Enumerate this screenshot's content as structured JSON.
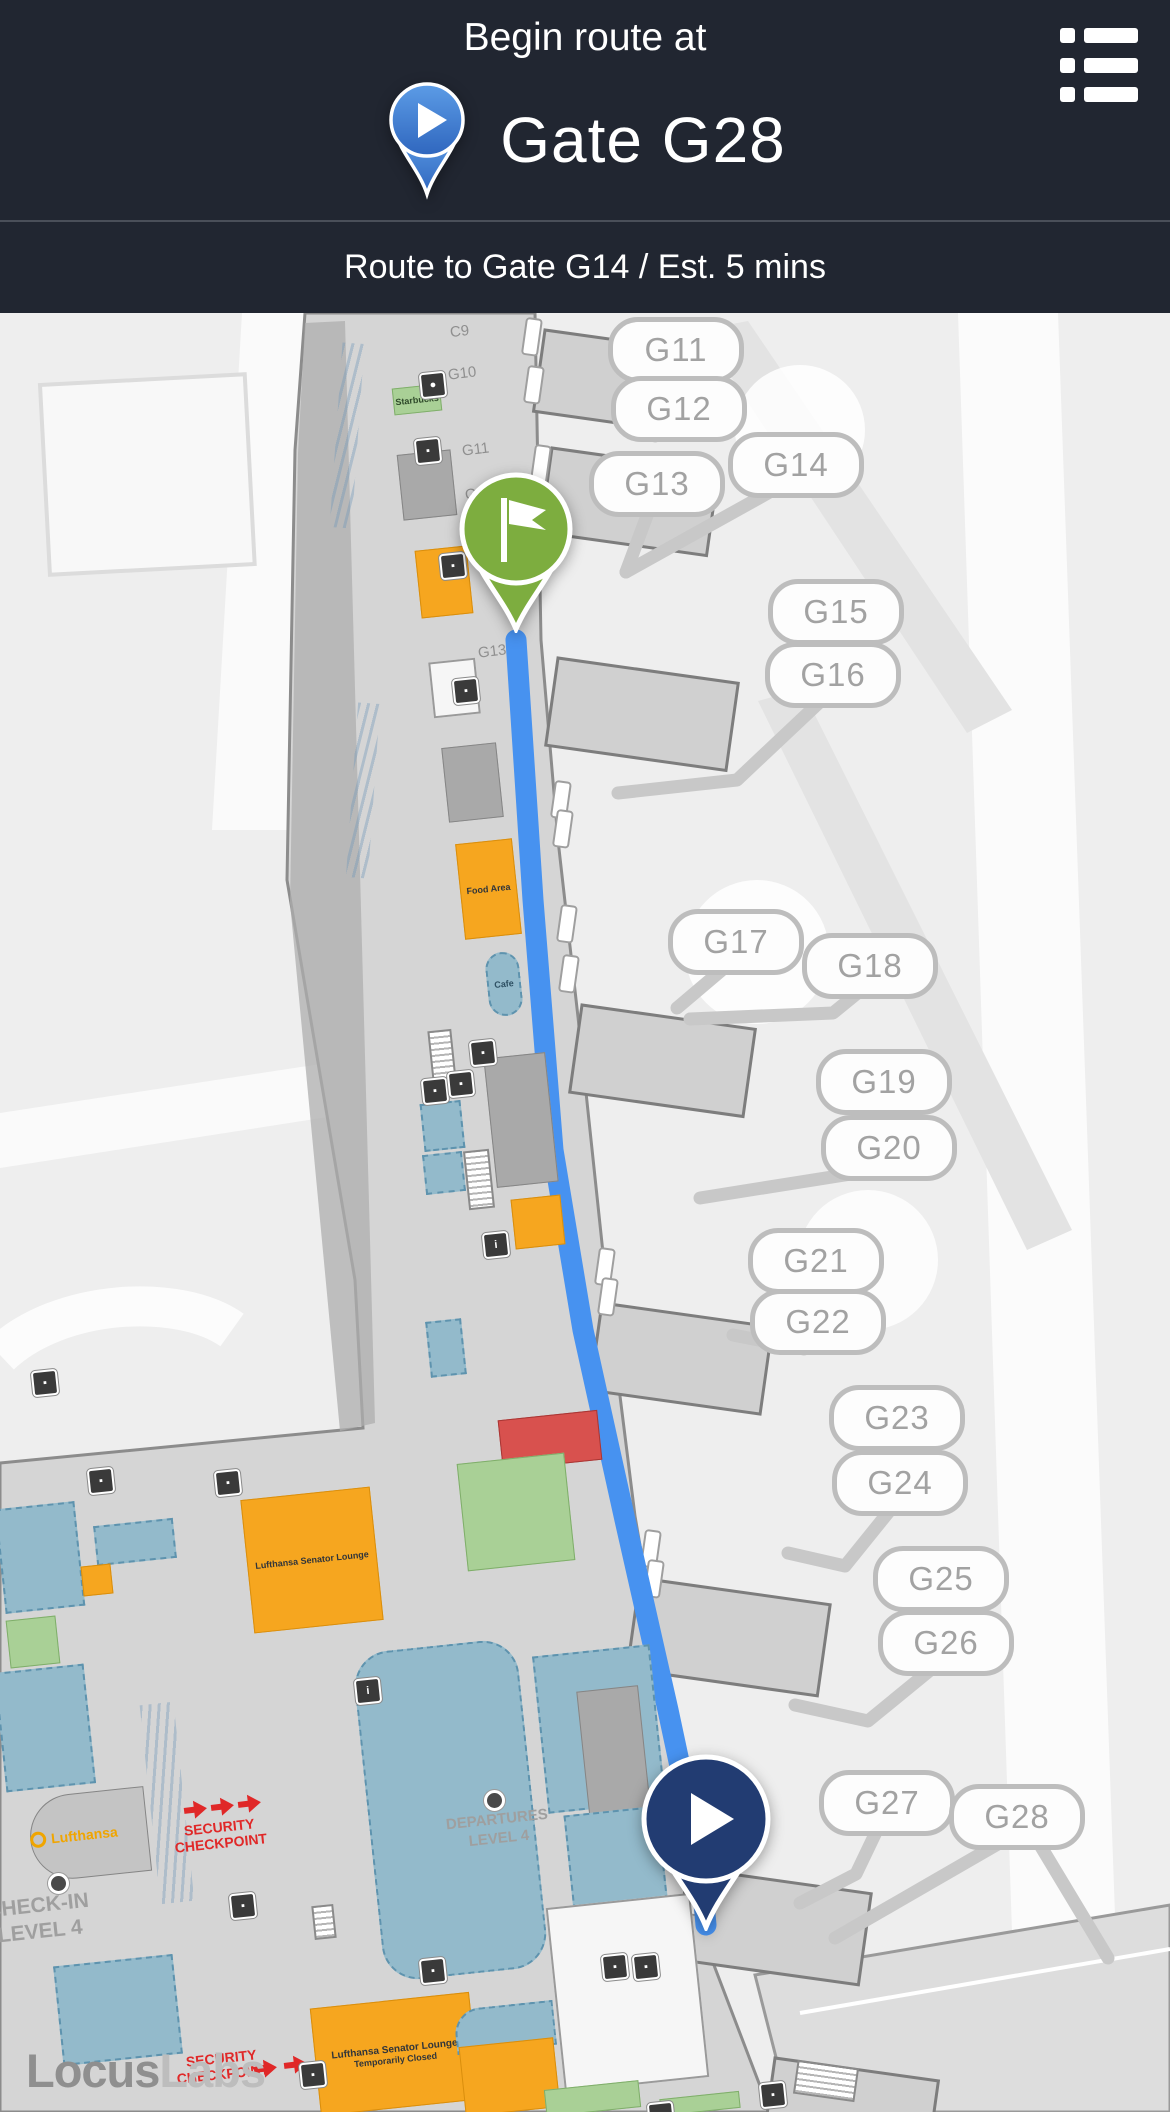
{
  "header": {
    "title": "Begin route at",
    "destination": "Gate G28"
  },
  "route_bar": {
    "text": "Route to Gate G14 / Est. 5 mins"
  },
  "map": {
    "gates": [
      {
        "label": "G11"
      },
      {
        "label": "G12"
      },
      {
        "label": "G13"
      },
      {
        "label": "G14"
      },
      {
        "label": "G15"
      },
      {
        "label": "G16"
      },
      {
        "label": "G17"
      },
      {
        "label": "G18"
      },
      {
        "label": "G19"
      },
      {
        "label": "G20"
      },
      {
        "label": "G21"
      },
      {
        "label": "G22"
      },
      {
        "label": "G23"
      },
      {
        "label": "G24"
      },
      {
        "label": "G25"
      },
      {
        "label": "G26"
      },
      {
        "label": "G27"
      },
      {
        "label": "G28"
      }
    ],
    "door_labels": [
      "C9",
      "G10",
      "G11",
      "G12",
      "G13"
    ],
    "labels": {
      "departures_1": "DEPARTURES",
      "departures_2": "LEVEL 4",
      "checkin_1": "CHECK-IN",
      "checkin_2": "LEVEL 4",
      "security_1": "SECURITY",
      "security_2": "CHECKPOINT",
      "lufthansa": "Lufthansa",
      "lounge_name": "Lufthansa Senator Lounge",
      "lounge_status": "Temporarily Closed",
      "starbucks": "Starbucks",
      "food_area": "Food Area",
      "cafe": "Cafe",
      "watermark_1": "Locus",
      "watermark_2": "Labs"
    },
    "colors": {
      "header_bg": "#212631",
      "route_line": "#4792F0",
      "start_pin": "#223C72",
      "destination_pin": "#7DAD3F",
      "header_pin": "#3D7BD0",
      "accent_orange": "#F6A61F",
      "security_red": "#E02828"
    }
  }
}
